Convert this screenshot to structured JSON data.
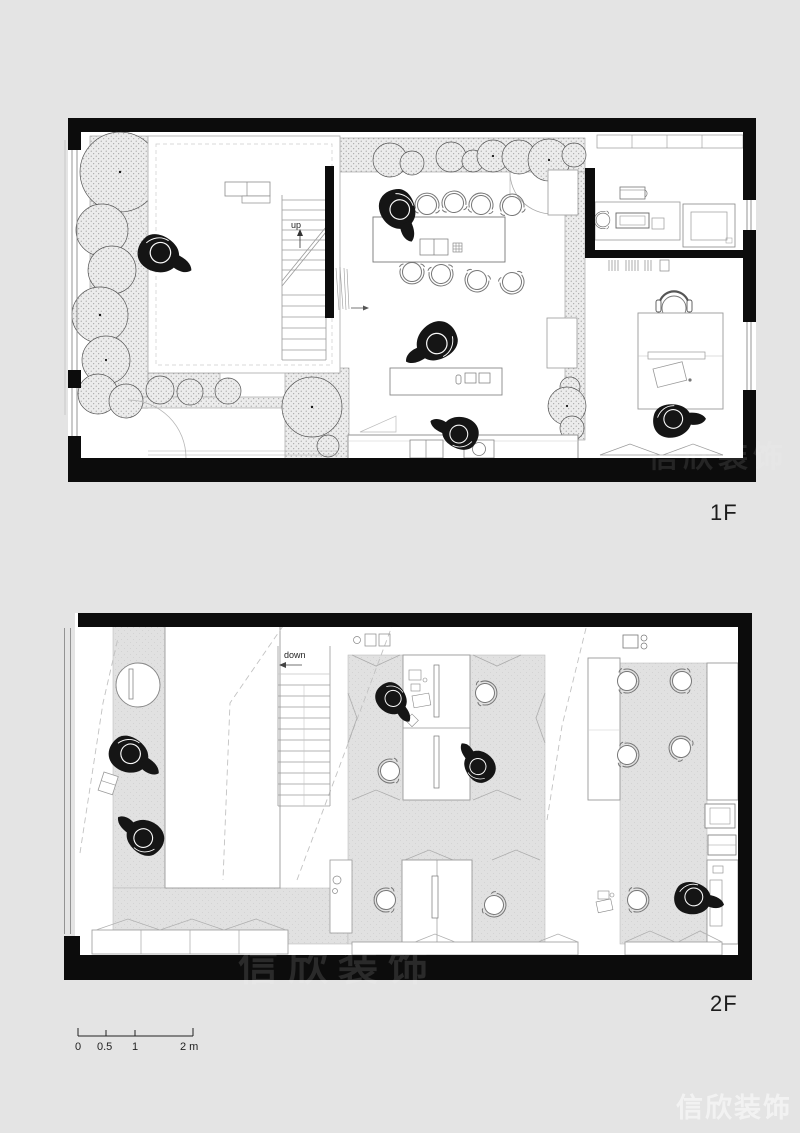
{
  "document": {
    "type": "architectural floor plan sheet",
    "background": "#e4e4e4",
    "paper": "#ffffff"
  },
  "plans": [
    {
      "name": "first-floor",
      "label": "1F",
      "stair_label": "up"
    },
    {
      "name": "second-floor",
      "label": "2F",
      "stair_label": "down"
    }
  ],
  "scale_bar": {
    "labels": [
      "0",
      "0.5",
      "1",
      "2 m"
    ]
  },
  "watermark": {
    "text": "信欣装饰"
  },
  "colors": {
    "wall": "#0c0c0c",
    "thin_line": "#8c8c8c",
    "floor_gray": "#e1e1e1",
    "stipple_bg": "#ececec",
    "figure_black": "#151515"
  }
}
